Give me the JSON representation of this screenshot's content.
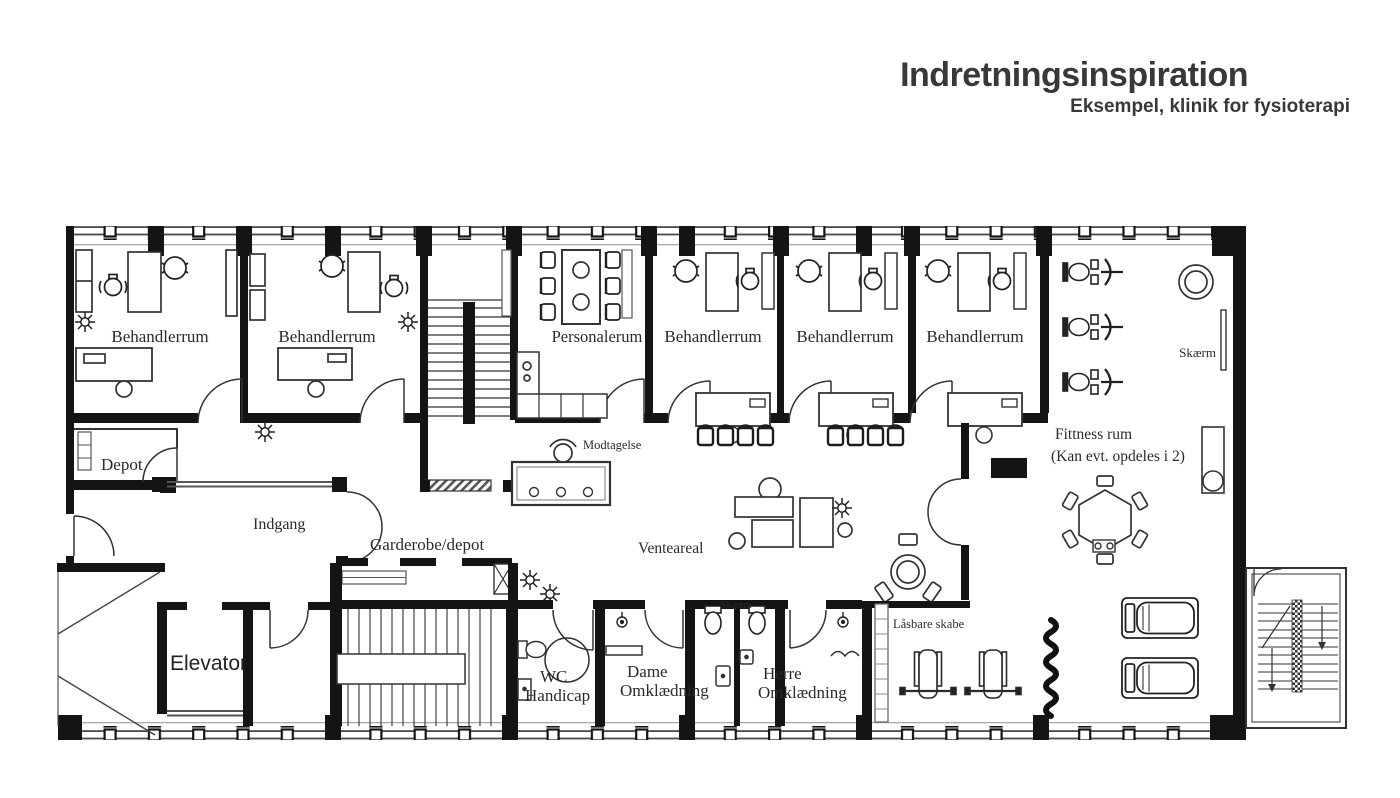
{
  "header": {
    "title": "Indretningsinspiration",
    "subtitle": "Eksempel, klinik for fysioterapi"
  },
  "rooms": {
    "behandlerrum": "Behandlerrum",
    "personalerum": "Personalerum",
    "depot": "Depot",
    "indgang": "Indgang",
    "garderobe_depot": "Garderobe/depot",
    "modtagelse": "Modtagelse",
    "venteareal": "Venteareal",
    "elevator": "Elevator",
    "wc_handicap": {
      "line1": "WC",
      "line2": "Handicap"
    },
    "dame_omklaedning": {
      "line1": "Dame",
      "line2": "Omklædning"
    },
    "herre_omklaedning": {
      "line1": "Herre",
      "line2": "Omklædning"
    },
    "fitness": {
      "line1": "Fittness rum",
      "line2": "(Kan evt. opdeles i 2)"
    }
  },
  "annotations": {
    "skaerm": "Skærm",
    "skaerm_stalls": "Skærm",
    "laasbare_skabe": "Låsbare skabe"
  },
  "colors": {
    "ink": "#1c1c1c",
    "wall": "#141414",
    "line": "#3a3a3a",
    "label": "#2e2a25",
    "background": "#ffffff"
  }
}
